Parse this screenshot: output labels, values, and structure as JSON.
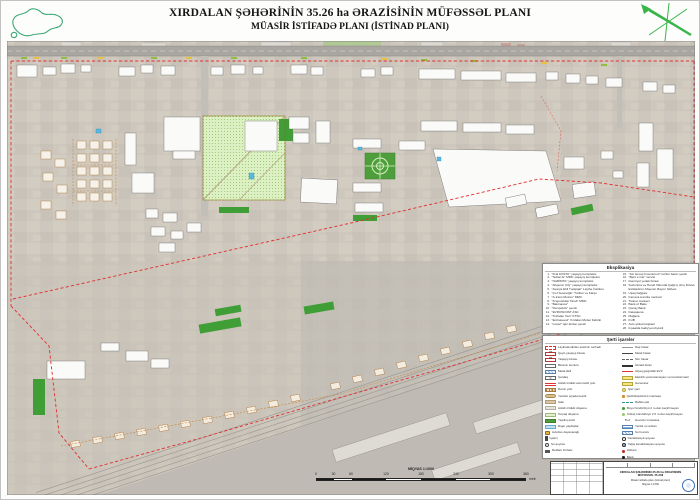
{
  "header": {
    "title_line1": "XIRDALAN ŞƏHƏRİNİN 35.26 ha ƏRAZİSİNİN MÜFƏSSƏL PLANI",
    "title_line2": "MÜASİR İSTİFADƏ PLANI (İSTİNAD PLANI)"
  },
  "accent_colors": {
    "boundary_red": "#e03030",
    "greenery": "#4f9e3c",
    "park_fill": "#d9efc3",
    "water_blue": "#57b8e0",
    "compass_green": "#39b54a"
  },
  "explication": {
    "title": "Eksplikasiya",
    "left": [
      {
        "n": "1",
        "t": "\"Kral KOSTA\" yaşayış kompleksi"
      },
      {
        "n": "2",
        "t": "\"Sultan E\" MMC yaşayış kompleksi"
      },
      {
        "n": "3",
        "t": "\"NARİMTA\" yaşayış kompleksi"
      },
      {
        "n": "4",
        "t": "\"Abşeron City\" yaşayış kompleksi"
      },
      {
        "n": "5",
        "t": "\"Asarya Ehli Tədqiqat\" Layihə İnstitutu"
      },
      {
        "n": "6",
        "t": "\"Ço Həsənoğlu\" Türklər və Karqo"
      },
      {
        "n": "7",
        "t": "\"A-trans Motors\" MMC"
      },
      {
        "n": "8",
        "t": "\"Krepostlular Tarəli\" MMC"
      },
      {
        "n": "9",
        "t": "\"Bakınasos\""
      },
      {
        "n": "10",
        "t": "\"Perspektiv\" şəxsli"
      },
      {
        "n": "11",
        "t": "\"EVROSCOM\" ASC"
      },
      {
        "n": "12",
        "t": "\"Tozlatan Xan\" KTSC"
      },
      {
        "n": "13",
        "t": "\"Embawood\" Xırdalan Mebel Fabriki"
      },
      {
        "n": "14",
        "t": "\"Lostel\" qaz-lövbər şəxsli"
      }
    ],
    "right": [
      {
        "n": "15",
        "t": "\"AG Group İnvestment\" körfəz balon şəxsli"
      },
      {
        "n": "16",
        "t": "\"Bənt e Car\" servisi"
      },
      {
        "n": "17",
        "t": "Dəmiryol yedək binası"
      },
      {
        "n": "18",
        "t": "Sudortma və Həndi Vidonda Çağırış üzrə Dövlət Extidadının Abşeron Rayon Şöbəsi"
      },
      {
        "n": "19",
        "t": "Uşaq bağçası"
      },
      {
        "n": "20",
        "t": "Kamera texnika mərkəzi"
      },
      {
        "n": "21",
        "t": "Ticarət mərkəzi"
      },
      {
        "n": "22",
        "t": "Bank of Baku"
      },
      {
        "n": "23",
        "t": "Qənay Bank"
      },
      {
        "n": "24",
        "t": "Kataqauna"
      },
      {
        "n": "25",
        "t": "Mağaza"
      },
      {
        "n": "26",
        "t": "KUB"
      },
      {
        "n": "27",
        "t": "Avto şirkəti köşkləri"
      },
      {
        "n": "28",
        "t": "İnşaatda fəaliyyət obyekti"
      }
    ]
  },
  "signs": {
    "title": "Şərti işarələr",
    "left": [
      {
        "sym": "boundary",
        "symtext": "",
        "label": "Layihələndirilən ərazinin sərhədi"
      },
      {
        "sym": "num27",
        "symtext": "27",
        "label": "Qeyri-yaşayış binası"
      },
      {
        "sym": "num28",
        "symtext": "28",
        "label": "Yaşayış binası"
      },
      {
        "sym": "whitebox",
        "symtext": "",
        "label": "Binanın konturu"
      },
      {
        "sym": "bluehatch",
        "symtext": "",
        "label": "Metal tikili"
      },
      {
        "sym": "cross",
        "symtext": "",
        "label": "Çardaq"
      },
      {
        "sym": "redlines",
        "symtext": "",
        "label": "Asfalt örtüklü avtomobil yolu"
      },
      {
        "sym": "rail",
        "symtext": "",
        "label": "Dəmir yolu"
      },
      {
        "sym": "diamond",
        "symtext": "",
        "label": "Yerüstü piyada keçidi"
      },
      {
        "sym": "tan",
        "symtext": "",
        "label": "Səki"
      },
      {
        "sym": "beige",
        "symtext": "",
        "label": "Asfalt örtüklü döşəmə"
      },
      {
        "sym": "lightgreen",
        "symtext": "",
        "label": "Torpaq döşəmə"
      },
      {
        "sym": "green",
        "symtext": "",
        "label": "Yaşıllıq ərazi"
      },
      {
        "sym": "bluebox",
        "symtext": "",
        "label": "Digər yaşıllıqlar"
      },
      {
        "sym": "bus",
        "symtext": "",
        "label": "Avtobus dayanacağı"
      },
      {
        "sym": "light",
        "symtext": "",
        "label": "İşıqfor"
      },
      {
        "sym": "well",
        "symtext": "",
        "label": "Su quyusu"
      },
      {
        "sym": "board",
        "symtext": "",
        "label": "Reklam lövhəsi"
      }
    ],
    "right": [
      {
        "sym": "linegrey",
        "symtext": "",
        "label": "Daş hasar"
      },
      {
        "sym": "linedark",
        "symtext": "",
        "label": "Metal hasar"
      },
      {
        "sym": "linedash",
        "symtext": "",
        "label": "Sim hasar"
      },
      {
        "sym": "linethick",
        "symtext": "",
        "label": "İstinad divarı"
      },
      {
        "sym": "linered",
        "symtext": "",
        "label": "Alçaq gərginlikli EVX"
      },
      {
        "sym": "yellowbox",
        "symtext": "",
        "label": "Elektrik yarımstansiyası və transformator"
      },
      {
        "sym": "yellowbox2",
        "symtext": "",
        "label": "Generator"
      },
      {
        "sym": "yellowcircle",
        "symtext": "",
        "label": "Qaz çəni"
      },
      {
        "sym": "dotorange",
        "symtext": "",
        "label": "Qazbölüşdürücü məntəqə"
      },
      {
        "sym": "commline",
        "symtext": "",
        "label": "Rabitə çatı"
      },
      {
        "sym": "tree",
        "symtext": "",
        "label": "Boyu hündürlüyü 2 m-dən keçirilməyən"
      },
      {
        "sym": "shrub",
        "symtext": "",
        "label": "Kolluq hündürlüyü 2.5 m-dən keçirilməyən"
      },
      {
        "sym": "tla",
        "symtext": "TLA",
        "label": "Hovuzlu müəssisə"
      },
      {
        "sym": "bluehatch2",
        "symtext": "",
        "label": "Yeraltı su anbarı"
      },
      {
        "sym": "bluehatch",
        "symtext": "",
        "label": "Su hovuzu"
      },
      {
        "sym": "circlek",
        "symtext": "",
        "label": "Kanalizasiya quyusu"
      },
      {
        "sym": "circley",
        "symtext": "",
        "label": "Yağış kanalizasiyası quyusu"
      },
      {
        "sym": "hydrant",
        "symtext": "",
        "label": "Hidrant"
      },
      {
        "sym": "dotblack",
        "symtext": "",
        "label": "Bank"
      },
      {
        "sym": "dotyellow",
        "symtext": "",
        "label": "Supermarket"
      }
    ]
  },
  "scalebar": {
    "label": "MİQYAS 1:1000",
    "ticks_m": [
      0,
      30,
      60,
      120,
      180,
      240,
      300,
      360
    ],
    "unit": "metr"
  },
  "titleblock": {
    "title1": "XIRDALAN ŞƏHƏRİNİN 35.26 ha ƏRAZİSİNİN",
    "title2": "MÜFƏSSƏL PLANI",
    "subtitle": "Müasir istifadə planı (istinad planı)",
    "scale": "Miqyas 1:1000"
  }
}
